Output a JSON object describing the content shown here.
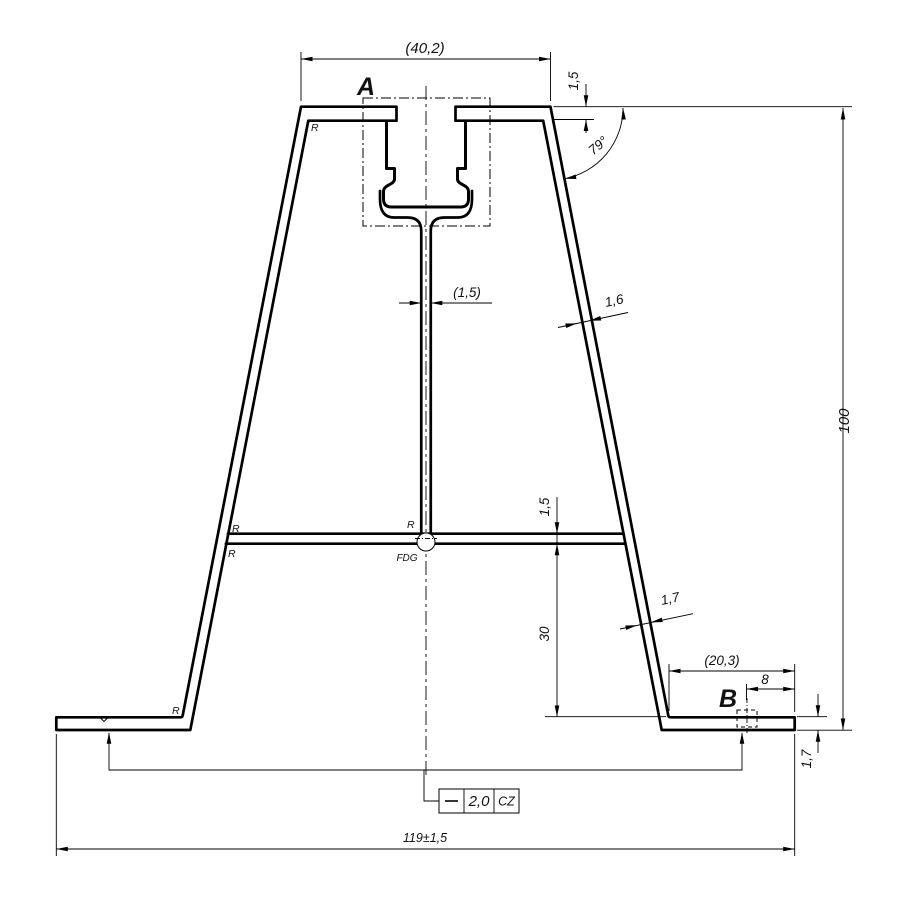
{
  "drawing_title": "aluminium-extrusion-profile-cross-section",
  "labels": {
    "detail_a": "A",
    "detail_b": "B",
    "datum": "FDG"
  },
  "dims": {
    "top_width": "(40,2)",
    "cap_thickness": "1,5",
    "wall_angle": "79°",
    "overall_height": "100",
    "web_thickness": "(1,5)",
    "upper_wall_thickness": "1,6",
    "rib_thickness": "1,5",
    "rib_to_base_height": "30",
    "lower_wall_thickness": "1,7",
    "flange_segment_width": "(20,3)",
    "detail_b_offset": "8",
    "flange_thickness": "1,7",
    "overall_width": "119±1,5"
  },
  "radius_marks": [
    "R",
    "R",
    "R",
    "R",
    "R"
  ],
  "tolerance_frame": {
    "characteristic": "straightness",
    "value": "2,0",
    "zone": "CZ"
  },
  "colors": {
    "ink": "#111111",
    "background": "#ffffff"
  }
}
